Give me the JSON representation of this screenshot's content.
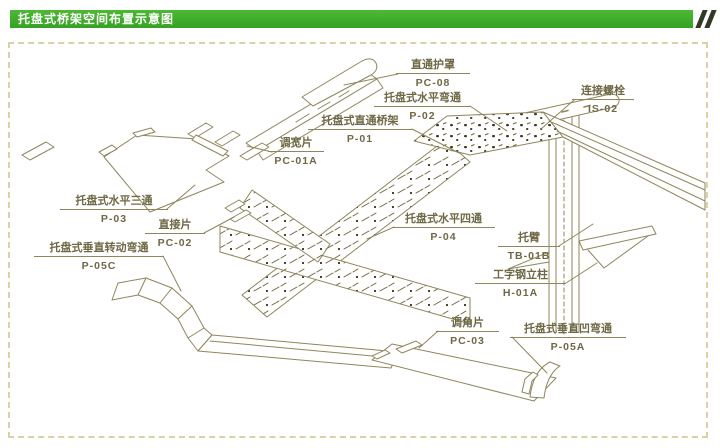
{
  "header": {
    "title": "托盘式桥架空间布置示意图"
  },
  "diagram": {
    "labels": [
      {
        "name": "直通护罩",
        "code": "PC-08"
      },
      {
        "name": "托盘式水平弯通",
        "code": "P-02"
      },
      {
        "name": "托盘式直通桥架",
        "code": "P-01"
      },
      {
        "name": "连接螺栓",
        "code": "IS-02"
      },
      {
        "name": "调宽片",
        "code": "PC-01A"
      },
      {
        "name": "托盘式水平三通",
        "code": "P-03"
      },
      {
        "name": "直接片",
        "code": "PC-02"
      },
      {
        "name": "托盘式垂直转动弯通",
        "code": "P-05C"
      },
      {
        "name": "托盘式水平四通",
        "code": "P-04"
      },
      {
        "name": "托臂",
        "code": "TB-01B"
      },
      {
        "name": "工字钢立柱",
        "code": "H-01A"
      },
      {
        "name": "调角片",
        "code": "PC-03"
      },
      {
        "name": "托盘式垂直凹弯通",
        "code": "P-05A"
      }
    ],
    "colors": {
      "drawing_line": "#8e865c",
      "label_text": "#6e6845",
      "header_green": "#3fae2e",
      "header_stripe": "#313a27",
      "frame_dash": "#d8d2a6",
      "texture_mark": "#3f3b22"
    }
  }
}
